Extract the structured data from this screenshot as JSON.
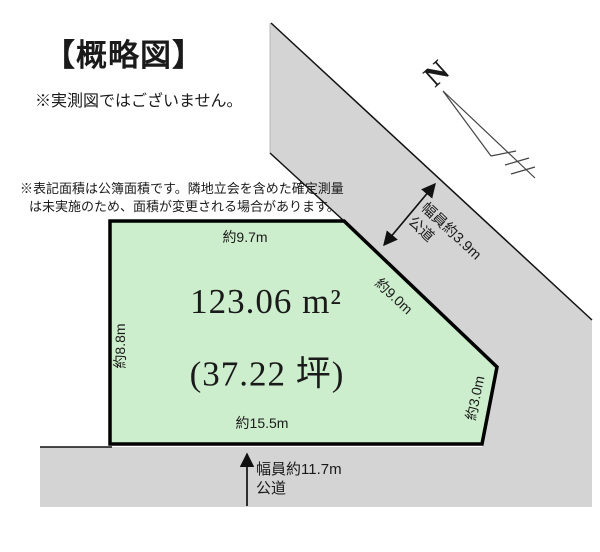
{
  "page": {
    "title": "【概略図】",
    "disclaimer": "※実測図ではございません。",
    "area_note_line1": "※表記面積は公簿面積です。隣地立会を含めた確定測量",
    "area_note_line2": "は未実施のため、面積が変更される場合があります。"
  },
  "plot": {
    "area_m2": "123.06 m²",
    "area_tsubo": "(37.22 坪)",
    "dimensions": {
      "top": "約9.7m",
      "left": "約8.8m",
      "bottom": "約15.5m",
      "diagonal_right": "約9.0m",
      "lower_right": "約3.0m"
    },
    "fill_color": "#cdeecd"
  },
  "roads": {
    "top_right": {
      "width_label": "幅員約3.9m",
      "type_label": "公道"
    },
    "bottom": {
      "width_label": "幅員約11.7m",
      "type_label": "公道"
    },
    "fill_color": "#d4d4d4"
  },
  "compass": {
    "north_label": "N"
  }
}
